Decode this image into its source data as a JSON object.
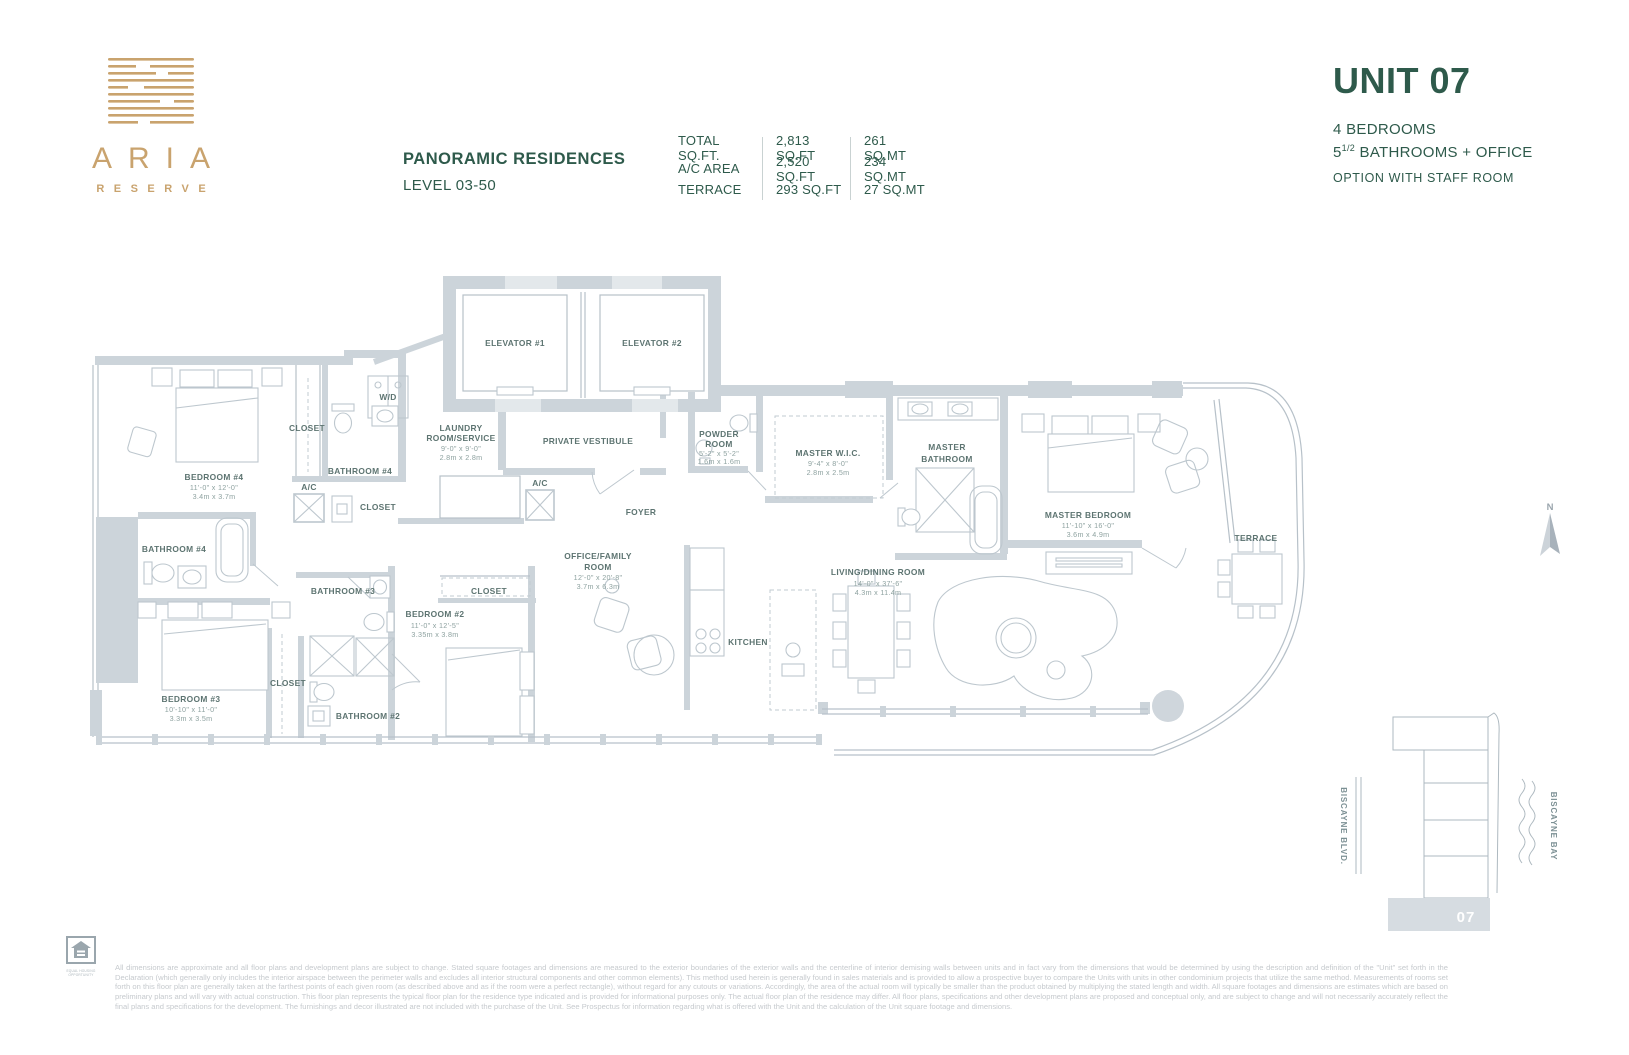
{
  "brand": {
    "name": "ARIA",
    "tagline": "RESERVE"
  },
  "header": {
    "collection": "PANORAMIC RESIDENCES",
    "level": "LEVEL 03-50",
    "stats": [
      {
        "label": "TOTAL SQ.FT.",
        "sqft": "2,813 SQ.FT",
        "sqmt": "261 SQ.MT"
      },
      {
        "label": "A/C AREA",
        "sqft": "2,520 SQ.FT",
        "sqmt": "234 SQ.MT"
      },
      {
        "label": "TERRACE",
        "sqft": "293 SQ.FT",
        "sqmt": "27 SQ.MT"
      }
    ]
  },
  "unit": {
    "title": "UNIT 07",
    "bedrooms": "4 BEDROOMS",
    "bath_num": "5",
    "bath_sup": "1/2",
    "bath_rest": " BATHROOMS + OFFICE",
    "option": "OPTION WITH STAFF ROOM"
  },
  "plan": {
    "rooms": {
      "laundry": {
        "n1": "LAUNDRY",
        "n2": "ROOM/SERVICE",
        "ft": "9'-0\" x 9'-0\"",
        "m": "2.8m x 2.8m"
      },
      "powder": {
        "n1": "POWDER",
        "n2": "ROOM",
        "ft": "5'-2\" x 5'-2\"",
        "m": "1.6m x 1.6m"
      },
      "wic": {
        "n1": "MASTER W.I.C.",
        "ft": "9'-4\" x 8'-0\"",
        "m": "2.8m x 2.5m"
      },
      "masterbath": {
        "n1": "MASTER",
        "n2": "BATHROOM"
      },
      "masterbed": {
        "n1": "MASTER BEDROOM",
        "ft": "11'-10\" x 16'-0\"",
        "m": "3.6m x 4.9m"
      },
      "bed4": {
        "n1": "BEDROOM #4",
        "ft": "11'-0\" x 12'-0\"",
        "m": "3.4m x 3.7m"
      },
      "office": {
        "n1": "OFFICE/FAMILY",
        "n2": "ROOM",
        "ft": "12'-0\" x 20'-8\"",
        "m": "3.7m x 6.3m"
      },
      "living": {
        "n1": "LIVING/DINING ROOM",
        "ft": "14'-0\" x 37'-6\"",
        "m": "4.3m x 11.4m"
      },
      "bed2": {
        "n1": "BEDROOM #2",
        "ft": "11'-0\" x 12'-5\"",
        "m": "3.35m x 3.8m"
      },
      "bed3": {
        "n1": "BEDROOM #3",
        "ft": "10'-10\" x 11'-0\"",
        "m": "3.3m x 3.5m"
      }
    },
    "labels": {
      "elevator1": "ELEVATOR #1",
      "elevator2": "ELEVATOR #2",
      "wd": "W/D",
      "closet_bed4": "CLOSET",
      "bath_service": "BATHROOM #4",
      "ac1": "A/C",
      "closet_service": "CLOSET",
      "ac2": "A/C",
      "vestibule": "PRIVATE VESTIBULE",
      "foyer": "FOYER",
      "bath4": "BATHROOM #4",
      "bath3": "BATHROOM #3",
      "closet_bed2": "CLOSET",
      "kitchen": "KITCHEN",
      "closet_bed3": "CLOSET",
      "bath2": "BATHROOM #2",
      "terrace": "TERRACE"
    }
  },
  "compass": {
    "north": "N"
  },
  "sitemap": {
    "street": "BISCAYNE BLVD.",
    "bay": "BISCAYNE BAY",
    "unit": "07"
  },
  "footer": {
    "eho": "EQUAL HOUSING OPPORTUNITY",
    "disclaimer": "All dimensions are approximate and all floor plans and development plans are subject to change. Stated square footages and dimensions are measured to the exterior boundaries of the exterior walls and the centerline of interior demising walls between units and in fact vary from the dimensions that would be determined by using the description and definition of the \"Unit\" set forth in the Declaration (which generally only includes the interior airspace between the perimeter walls and excludes all interior structural components and other common elements). This method used herein is generally found in sales materials and is provided to allow a prospective buyer to compare the Units with units in other condominium projects that utilize the same method. Measurements of rooms set forth on this floor plan are generally taken at the farthest points of each given room (as described above and as if the room were a perfect rectangle), without regard for any cutouts or variations. Accordingly, the area of the actual room will typically be smaller than the product obtained by multiplying the stated length and width. All square footages and dimensions are estimates which are based on preliminary plans and will vary with actual construction. This floor plan represents the typical floor plan for the residence type indicated and is provided for informational purposes only. The actual floor plan of the residence may differ. All floor plans, specifications and other development plans are proposed and conceptual only, and are subject to change and will not necessarily accurately reflect the final plans and specifications for the development. The furnishings and decor illustrated are not included with the purchase of the Unit. See Prospectus for information regarding what is offered with the Unit and the calculation of the Unit square footage and dimensions."
  }
}
